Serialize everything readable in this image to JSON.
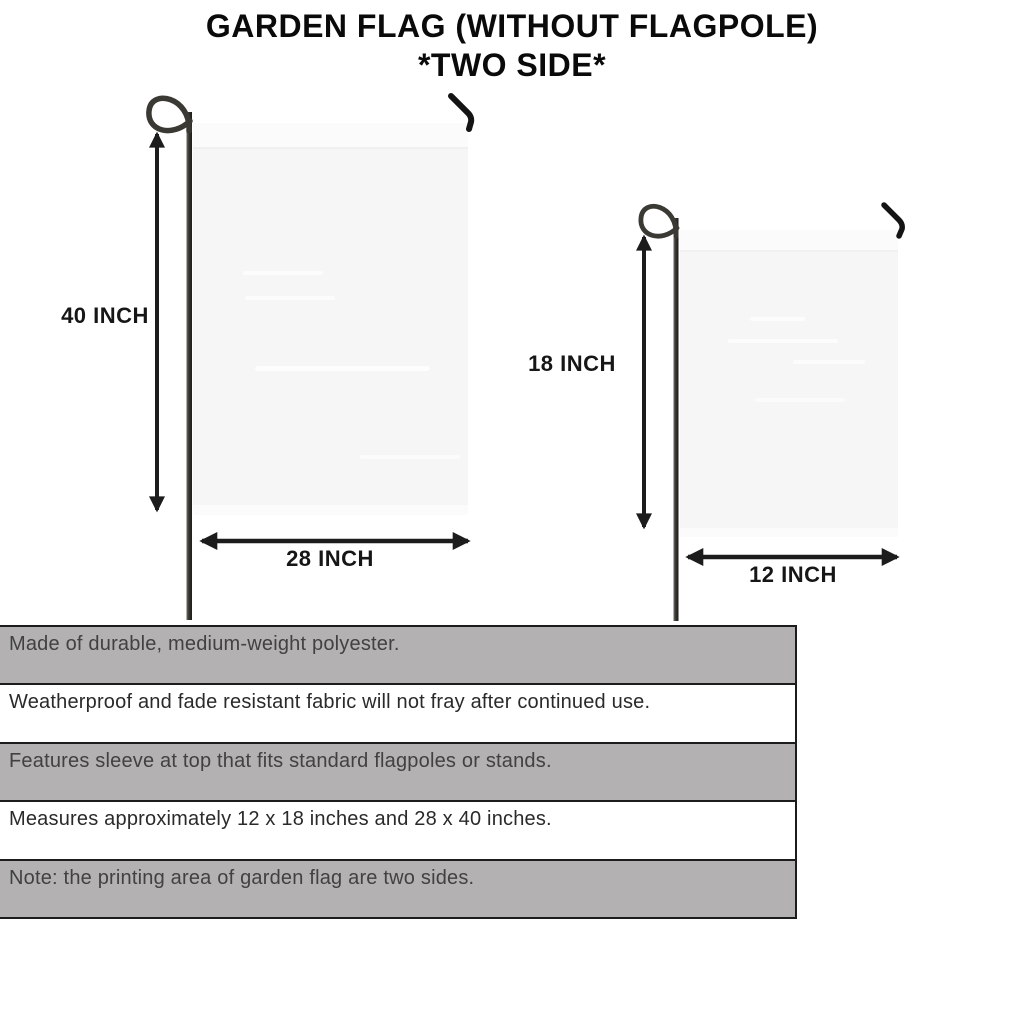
{
  "title": {
    "line1": "GARDEN FLAG (WITHOUT FLAGPOLE)",
    "line2": "*TWO SIDE*"
  },
  "diagram": {
    "large_flag": {
      "height_label": "40 INCH",
      "width_label": "28 INCH"
    },
    "small_flag": {
      "height_label": "18 INCH",
      "width_label": "12 INCH"
    }
  },
  "features": {
    "rows": [
      {
        "text": "Made of durable, medium-weight polyester."
      },
      {
        "text": "Weatherproof and fade resistant fabric will not fray after continued use."
      },
      {
        "text": "Features sleeve at top that fits standard flagpoles or stands."
      },
      {
        "text": "Measures approximately 12 x 18 inches and 28 x 40 inches."
      },
      {
        "text": "Note: the printing area of garden flag are two sides."
      }
    ]
  },
  "colors": {
    "flag_fill": "#f6f6f6",
    "flag_sleeve": "#fbfbfb",
    "pole": "#2e2d29",
    "arrow": "#1c1c1c",
    "table_shaded_row": "#b3b1b1",
    "table_border": "#1c1c1c",
    "title_text": "#0a0a0a"
  }
}
